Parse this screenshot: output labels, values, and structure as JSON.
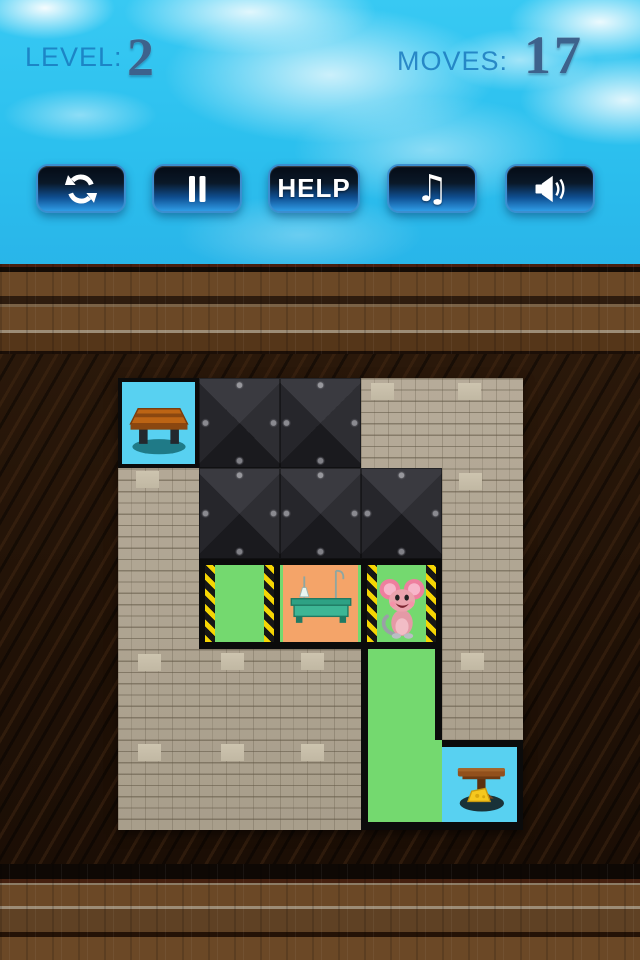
{
  "hud": {
    "level_label": "LEVEL:",
    "level_value": "2",
    "moves_label": "MOVES:",
    "moves_value": "17"
  },
  "toolbar": {
    "buttons": [
      {
        "name": "restart",
        "icon": "refresh-icon"
      },
      {
        "name": "pause",
        "icon": "pause-icon"
      },
      {
        "name": "help",
        "label": "HELP"
      },
      {
        "name": "music",
        "icon": "music-note-icon",
        "glyph": "♫"
      },
      {
        "name": "sound",
        "icon": "speaker-icon"
      }
    ]
  },
  "board": {
    "rows": 5,
    "cols": 5,
    "cells": [
      [
        "goal-bench",
        "metal",
        "metal",
        "brick",
        "brick"
      ],
      [
        "brick",
        "metal",
        "metal",
        "metal",
        "brick"
      ],
      [
        "brick",
        "room-green",
        "room-orange-table",
        "room-green-mouse",
        "brick"
      ],
      [
        "brick",
        "brick",
        "brick",
        "corridor-green",
        "brick"
      ],
      [
        "brick",
        "brick",
        "brick",
        "corridor-green",
        "goal-cheese"
      ]
    ],
    "legend": {
      "goal-bench": "cyan goal tile with wooden bench",
      "metal": "riveted steel plate (blocked)",
      "brick": "stone brick wall",
      "room-green": "green room with hazard-striped walls",
      "room-orange-table": "orange lab room with teal table",
      "room-green-mouse": "green hazard room holding the mouse",
      "corridor-green": "green corridor",
      "goal-cheese": "cyan goal tile with table and cheese"
    }
  },
  "colors": {
    "sky": "#2cc0ee",
    "button_blue": "#2f9ce6",
    "room_green": "#74d96f",
    "room_orange": "#f4a469",
    "goal_cyan": "#58d1f1",
    "hazard_yellow": "#f5d503",
    "brick_tan": "#b0a593",
    "metal_gray": "#2a2a2f",
    "wood_brown": "#6b4826"
  }
}
